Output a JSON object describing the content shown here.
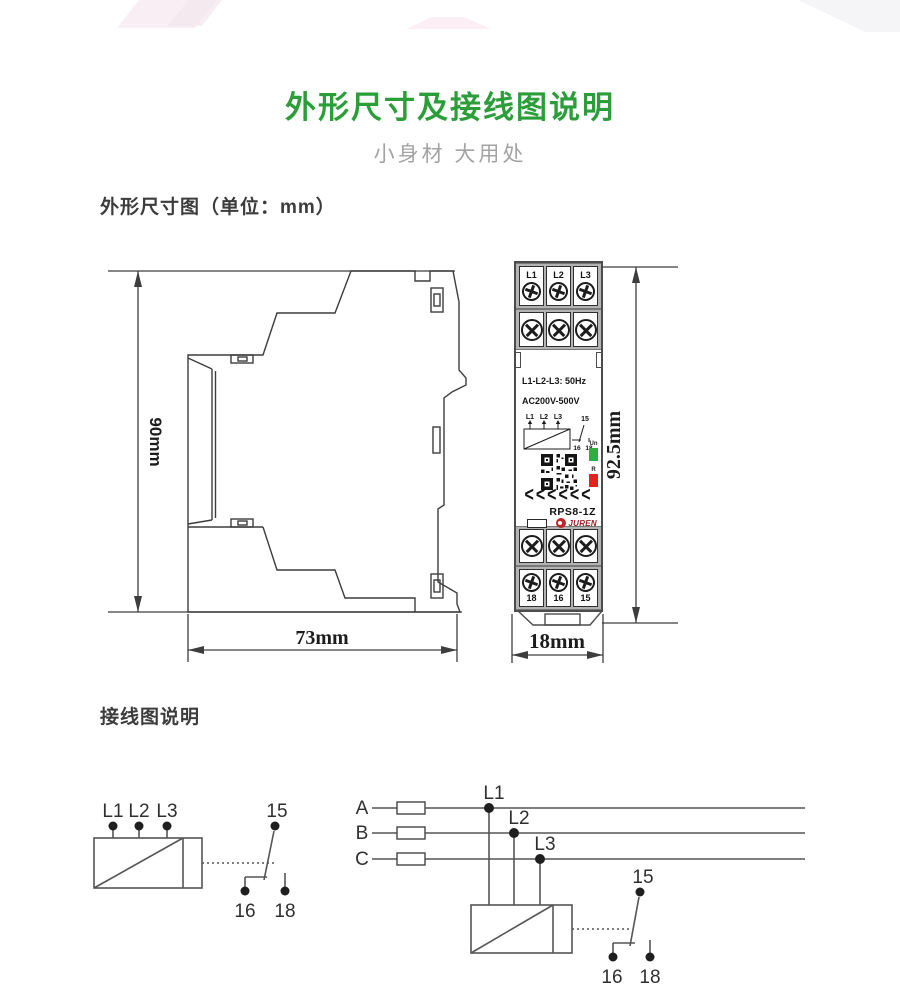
{
  "page": {
    "title": "外形尺寸及接线图说明",
    "subtitle": "小身材 大用处"
  },
  "sections": {
    "dimensions_heading": "外形尺寸图（单位：mm）",
    "wiring_heading": "接线图说明"
  },
  "side_view": {
    "height_label": "90mm",
    "width_label": "73mm"
  },
  "front_view": {
    "height_label": "92.5mm",
    "width_label": "18mm",
    "top_terminals": [
      "L1",
      "L2",
      "L3"
    ],
    "bottom_terminals": [
      "18",
      "16",
      "15"
    ],
    "spec_line1": "L1-L2-L3: 50Hz",
    "spec_line2": "AC200V-500V",
    "mini_diagram": {
      "inputs": [
        "L1",
        "L2",
        "L3"
      ],
      "no_label": "15",
      "nc_label": "16",
      "com_label": "18"
    },
    "led_green_label": "Un",
    "led_red_label": "R",
    "chevrons": "<<<<<<",
    "model": "RPS8-1Z",
    "brand": "JUREN"
  },
  "wiring_left": {
    "inputs": [
      "L1",
      "L2",
      "L3"
    ],
    "contact_15": "15",
    "contact_16": "16",
    "contact_18": "18"
  },
  "wiring_right": {
    "phases": [
      "A",
      "B",
      "C"
    ],
    "taps": [
      "L1",
      "L2",
      "L3"
    ],
    "contact_15": "15",
    "contact_16": "16",
    "contact_18": "18"
  },
  "colors": {
    "title_green": "#2b9e3a",
    "led_green": "#2fae47",
    "led_red": "#e02424",
    "brand_red": "#c0242b"
  }
}
